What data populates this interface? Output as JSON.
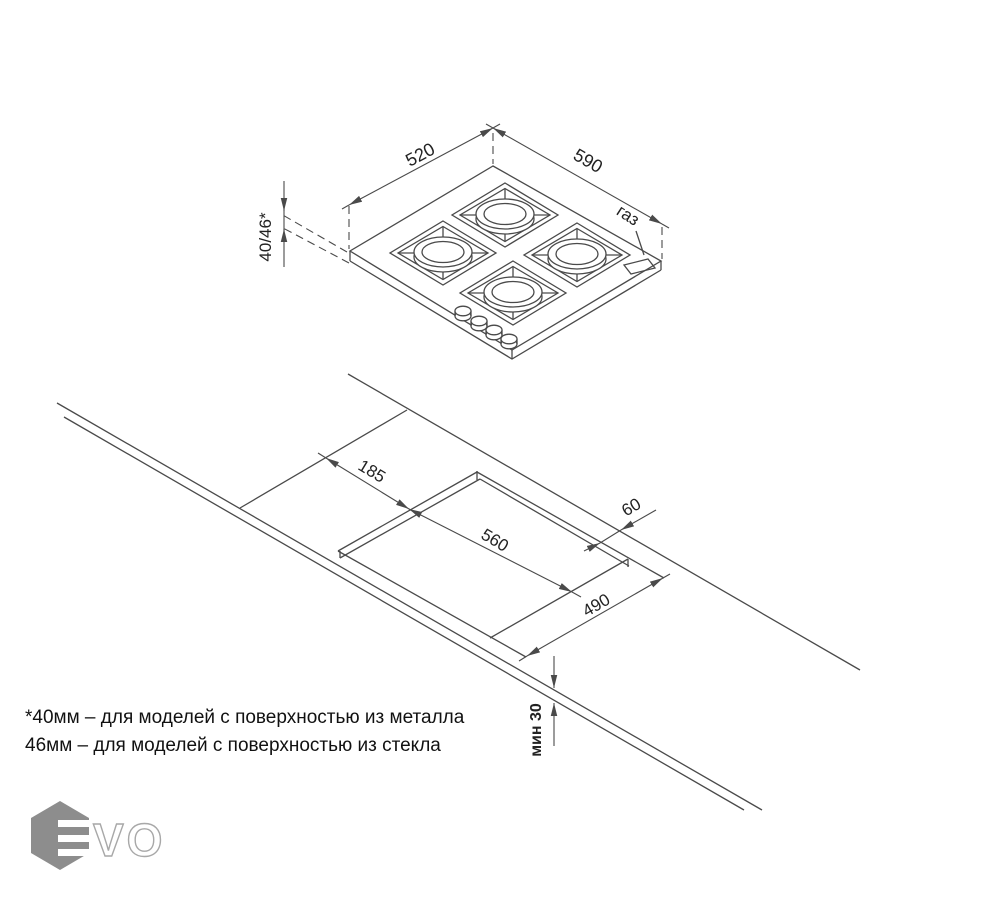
{
  "colors": {
    "line": "#4a4a4a",
    "text": "#222222",
    "logo_gray": "#8d8d8d"
  },
  "hob_view": {
    "title": "isometric view of 4-burner gas hob",
    "width": "520",
    "depth": "590",
    "height": "40/46*",
    "gas": "газ"
  },
  "cutout_view": {
    "title": "worktop cutout installation drawing",
    "side_offset": "185",
    "cut_length": "560",
    "back_gap": "60",
    "cut_width": "490",
    "front_min": "мин 30"
  },
  "footnotes": {
    "line1": "*40мм – для моделей с поверхностью из металла",
    "line2": "46мм – для моделей с поверхностью из стекла"
  },
  "logo": {
    "letters": "VO"
  }
}
